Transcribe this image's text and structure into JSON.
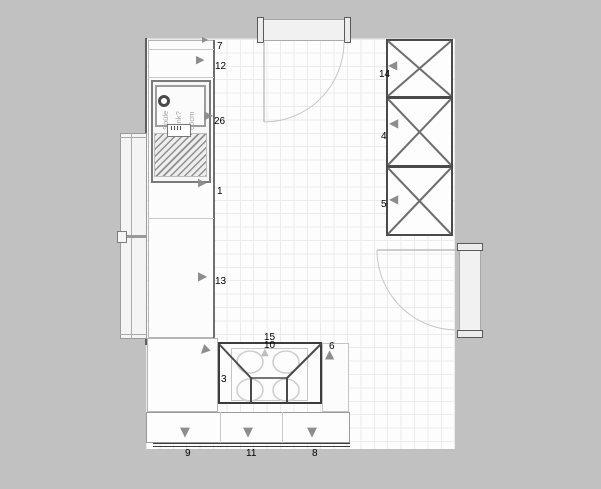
{
  "colors": {
    "exterior": "#c1c1c1",
    "floor": "#fdfdfd",
    "grid": "#ebebeb",
    "outline_dark": "#3c3c3c",
    "outline_light": "#b5b5b5",
    "arrow_gray": "#8d8d8d",
    "label_color": "#000000"
  },
  "icons": {
    "arrow_right": "▶",
    "arrow_left": "◀",
    "arrow_down": "▼",
    "arrow_up": "▲"
  },
  "labels": {
    "item7": "7",
    "item12": "12",
    "item26": "26",
    "item1": "1",
    "item13": "13",
    "item14": "14",
    "item4": "4",
    "item5": "5",
    "item3": "3",
    "item15": "15",
    "item10": "10",
    "item6": "6",
    "item9": "9",
    "item11": "11",
    "item8": "8"
  },
  "sink_note": {
    "line1": "Spüle",
    "line2": "Sink?",
    "line3": "60cm"
  }
}
